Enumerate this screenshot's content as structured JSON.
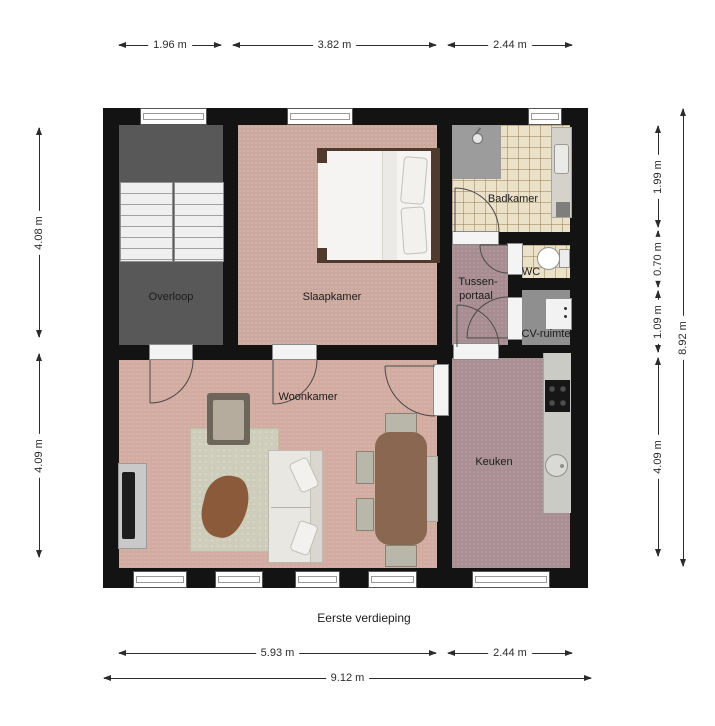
{
  "title": "Eerste verdieping",
  "rooms": {
    "overloop": "Overloop",
    "slaapkamer": "Slaapkamer",
    "badkamer": "Badkamer",
    "wc": "WC",
    "tussenportaal1": "Tussen-",
    "tussenportaal2": "portaal",
    "cv": "CV-ruimte",
    "woonkamer": "Woonkamer",
    "keuken": "Keuken"
  },
  "dims": {
    "top": [
      "1.96 m",
      "3.82 m",
      "2.44 m"
    ],
    "left": [
      "4.08 m",
      "4.09 m"
    ],
    "right_inner": [
      "1.99 m",
      "0.70 m",
      "1.09 m",
      "4.09 m"
    ],
    "right_outer": [
      "8.92 m"
    ],
    "bottom_inner": [
      "5.93 m",
      "2.44 m"
    ],
    "bottom_outer": [
      "9.12 m"
    ]
  },
  "colors": {
    "wall": "#131313",
    "overloop_floor": "#585858",
    "bedroom_floor": "#cba99e",
    "living_floor": "#d2aba1",
    "hall_floor": "#a78d92",
    "kitchen_floor": "#a98f94",
    "bathroom_tile": "#ebe1c8",
    "cv_floor": "#8f8f8f"
  }
}
